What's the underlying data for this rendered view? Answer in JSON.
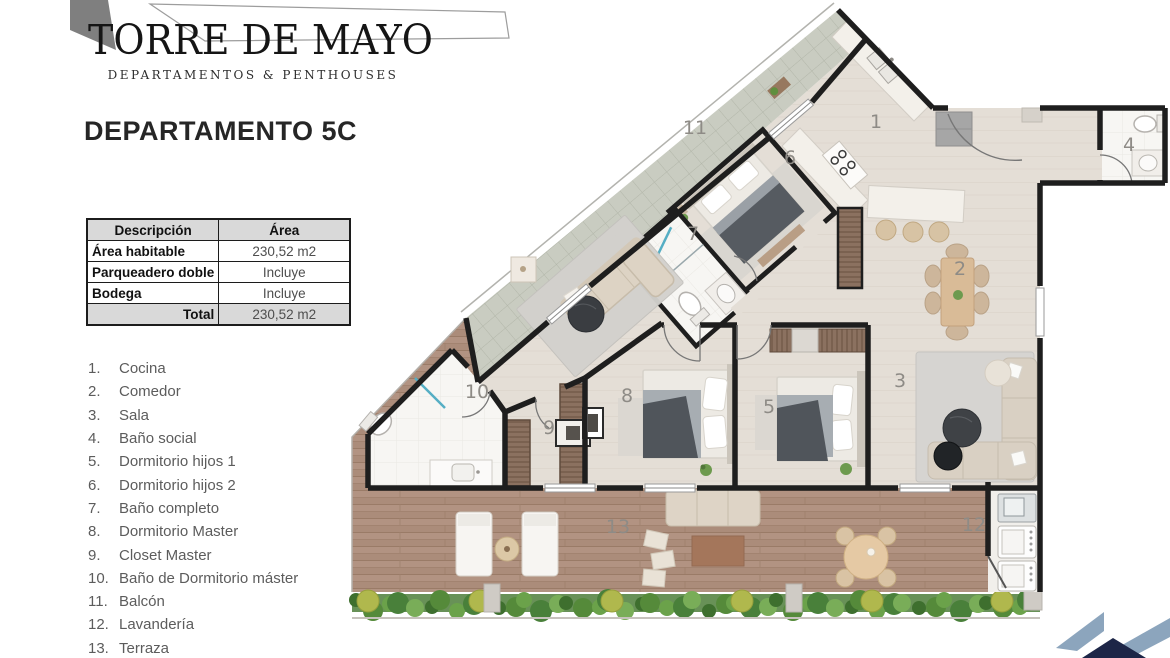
{
  "brand": {
    "name": "TORRE DE MAYO",
    "tagline": "DEPARTAMENTOS & PENTHOUSES"
  },
  "page": {
    "title": "DEPARTAMENTO 5C"
  },
  "area_table": {
    "headers": [
      "Descripción",
      "Área"
    ],
    "rows": [
      [
        "Área habitable",
        "230,52 m2"
      ],
      [
        "Parqueadero doble",
        "Incluye"
      ],
      [
        "Bodega",
        "Incluye"
      ]
    ],
    "total": {
      "label": "Total",
      "value": "230,52 m2"
    }
  },
  "legend": [
    [
      "1.",
      "Cocina"
    ],
    [
      "2.",
      "Comedor"
    ],
    [
      "3.",
      "Sala"
    ],
    [
      "4.",
      "Baño social"
    ],
    [
      "5.",
      "Dormitorio hijos 1"
    ],
    [
      "6.",
      "Dormitorio hijos 2"
    ],
    [
      "7.",
      "Baño completo"
    ],
    [
      "8.",
      "Dormitorio Master"
    ],
    [
      "9.",
      "Closet Master"
    ],
    [
      "10.",
      "Baño de Dormitorio máster"
    ],
    [
      "11.",
      "Balcón"
    ],
    [
      "12.",
      "Lavandería"
    ],
    [
      "13.",
      "Terraza"
    ]
  ],
  "floorplan": {
    "rooms": [
      {
        "n": "1",
        "x": 876,
        "y": 128
      },
      {
        "n": "2",
        "x": 960,
        "y": 275
      },
      {
        "n": "3",
        "x": 900,
        "y": 387
      },
      {
        "n": "4",
        "x": 1129,
        "y": 151
      },
      {
        "n": "5",
        "x": 769,
        "y": 413
      },
      {
        "n": "6",
        "x": 790,
        "y": 164
      },
      {
        "n": "7",
        "x": 693,
        "y": 240
      },
      {
        "n": "8",
        "x": 627,
        "y": 402
      },
      {
        "n": "9",
        "x": 549,
        "y": 434
      },
      {
        "n": "10",
        "x": 477,
        "y": 398
      },
      {
        "n": "11",
        "x": 695,
        "y": 134
      },
      {
        "n": "12",
        "x": 974,
        "y": 531
      },
      {
        "n": "13",
        "x": 618,
        "y": 533
      }
    ]
  },
  "colors": {
    "wall": "#1e1e1e",
    "floor": "#e4ded6",
    "wood": "#b29382",
    "balcony_tile": "#c9ccc1",
    "logo_light": "#8ca5bd",
    "logo_dark": "#1d2647"
  }
}
